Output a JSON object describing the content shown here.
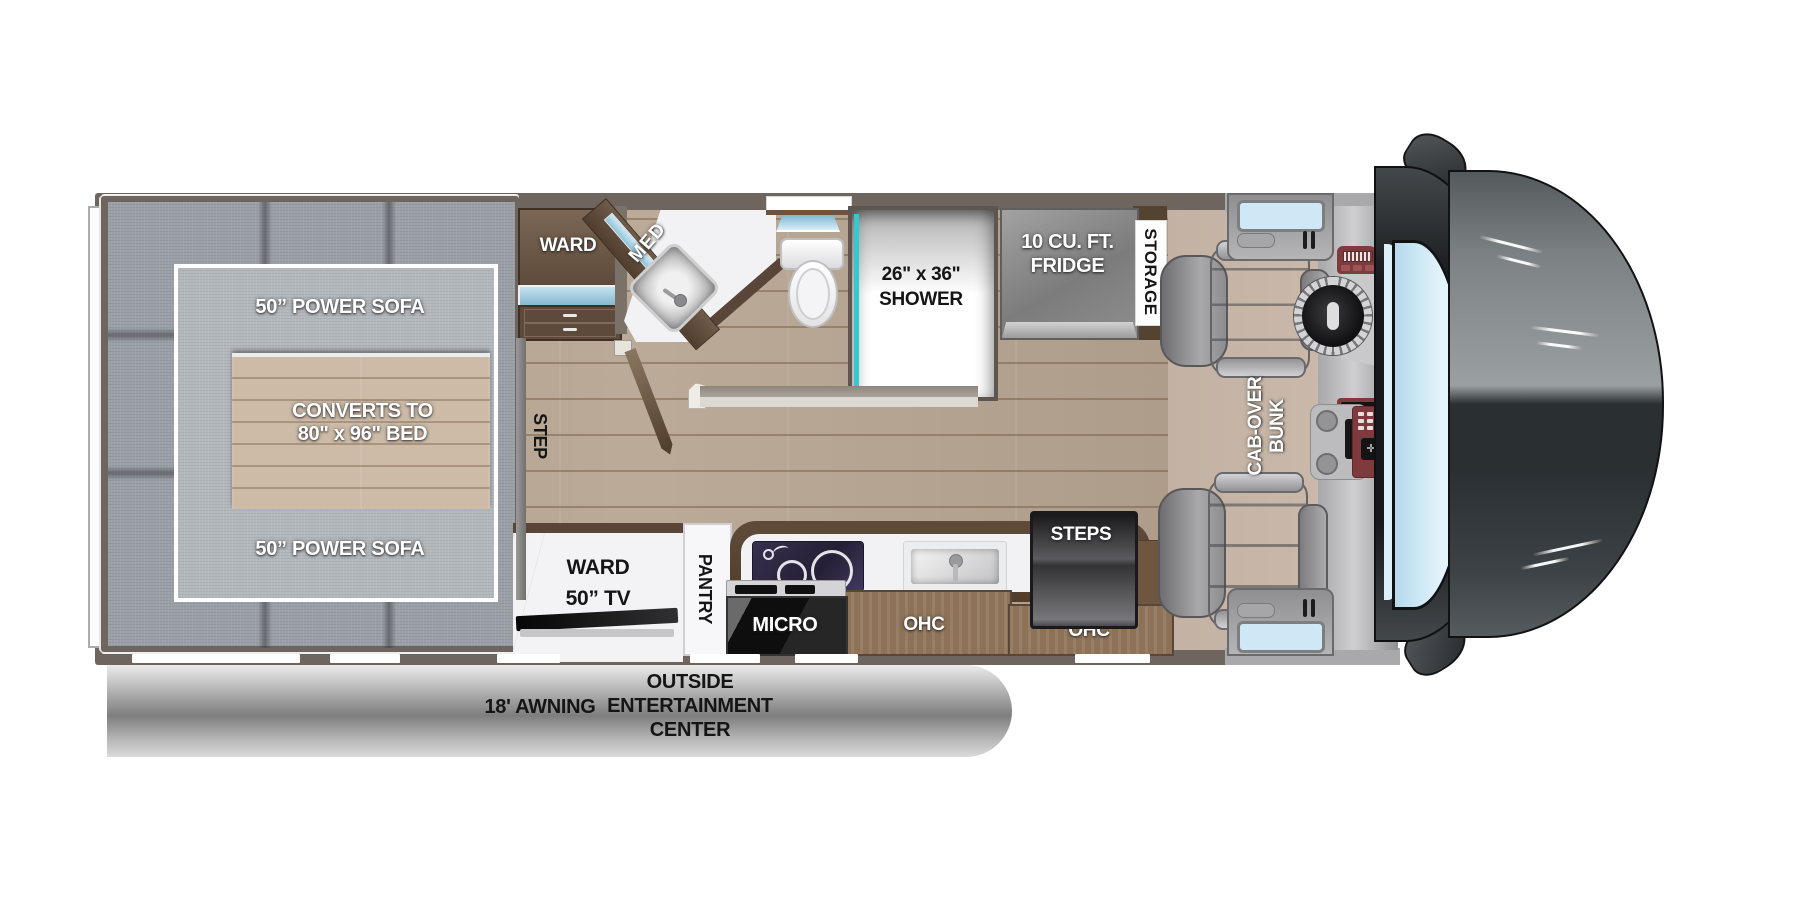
{
  "title": "Class C motorhome floor plan",
  "labels": {
    "sofa_top": "50” POWER SOFA",
    "sofa_bottom": "50” POWER SOFA",
    "bed_1": "CONVERTS TO",
    "bed_2": "80\" x 96\" BED",
    "ward": "WARD",
    "med": "MED",
    "shower_1": "26\" x 36\"",
    "shower_2": "SHOWER",
    "fridge_1": "10 CU. FT.",
    "fridge_2": "FRIDGE",
    "storage": "STORAGE",
    "step": "STEP",
    "cab_over_1": "CAB-OVER",
    "cab_over_2": "BUNK",
    "ward_tv_1": "WARD",
    "ward_tv_2": "50” TV",
    "pantry": "PANTRY",
    "micro": "MICRO",
    "ohc_1": "OHC",
    "ohc_2": "OHC",
    "steps": "STEPS",
    "awning": "18' AWNING",
    "outside_1": "OUTSIDE",
    "outside_2": "ENTERTAINMENT CENTER"
  },
  "colors": {
    "wall": "#6e655e",
    "wood_floor": "#b7a591",
    "cabinet_brown": "#5f4b3a",
    "shower_glass_teal": "#35c8cd",
    "window_blue": "#cfe8f5",
    "awning_gray": "#8d8d8d"
  }
}
